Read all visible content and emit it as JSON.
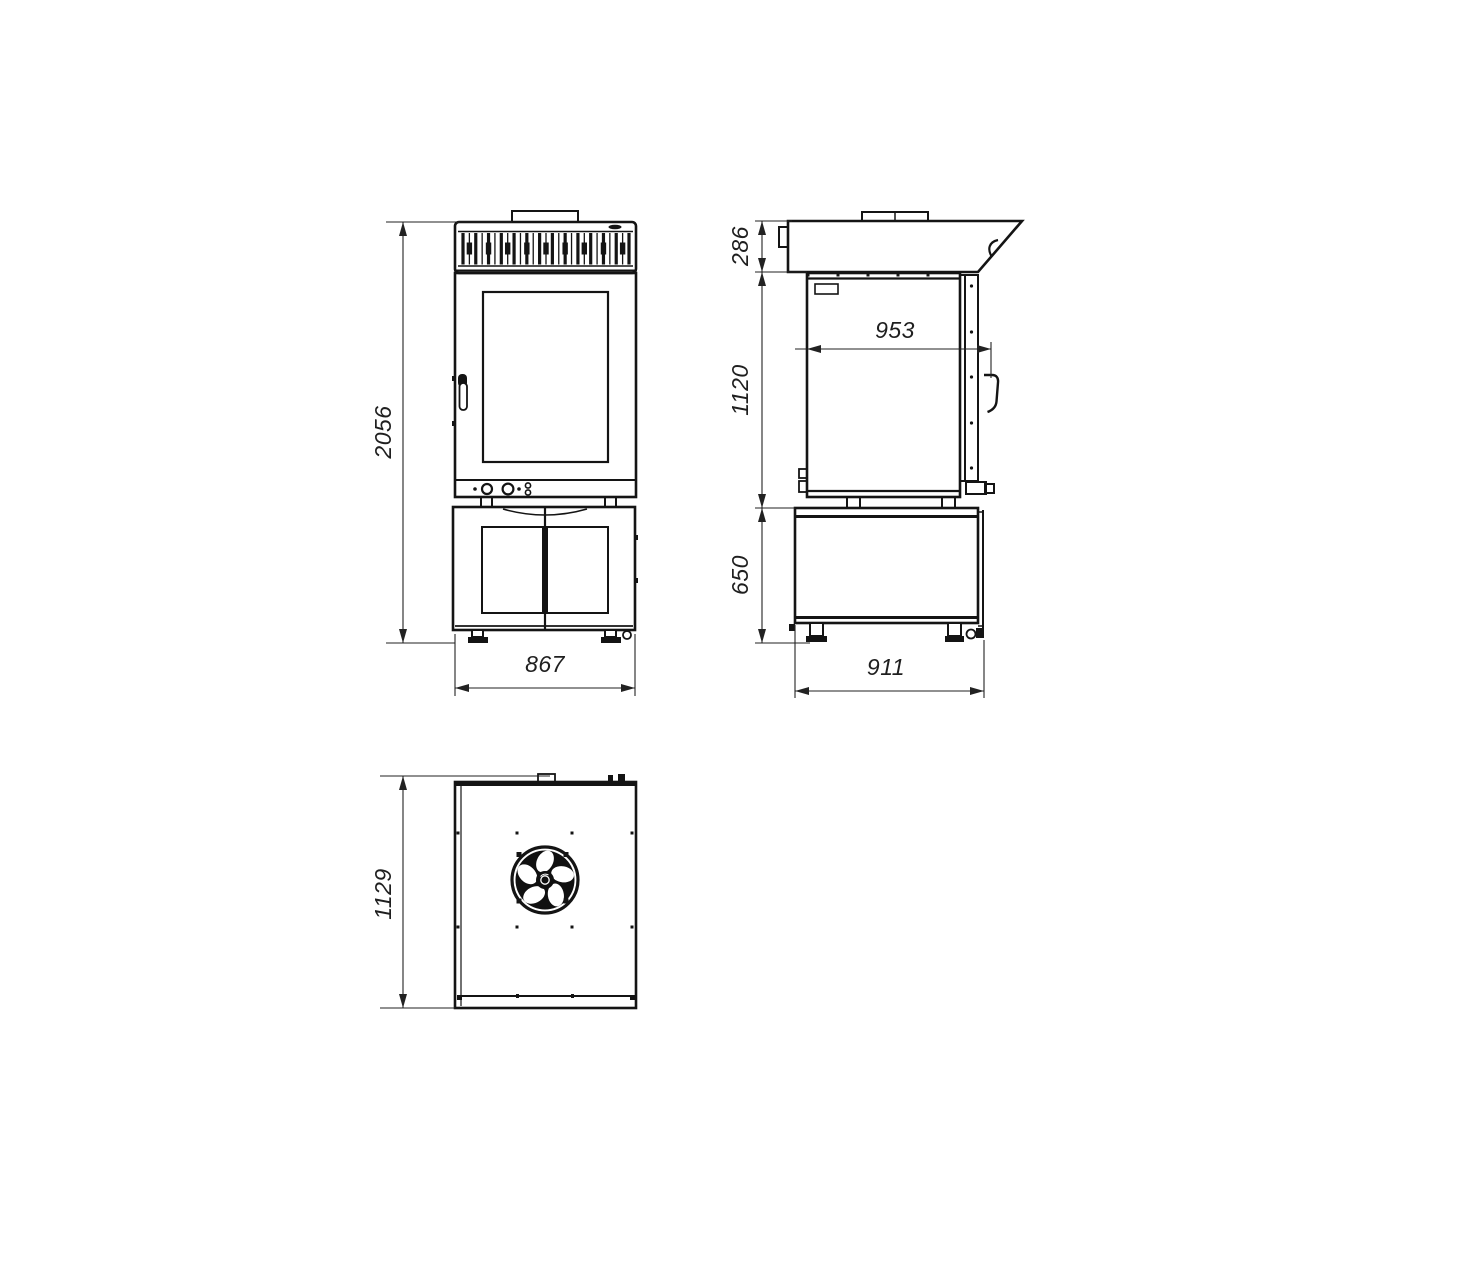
{
  "drawing": {
    "background": "#ffffff",
    "line_color": "#141414",
    "dim_line_color": "#222222",
    "views": {
      "front": {
        "name": "front-view"
      },
      "side": {
        "name": "side-view"
      },
      "top": {
        "name": "top-view"
      }
    },
    "dims": {
      "front_height": "2056",
      "front_width": "867",
      "side_hood_height": "286",
      "side_body_height": "1120",
      "side_body_depth": "953",
      "side_stand_height": "650",
      "side_stand_depth": "911",
      "top_depth": "1129"
    }
  }
}
